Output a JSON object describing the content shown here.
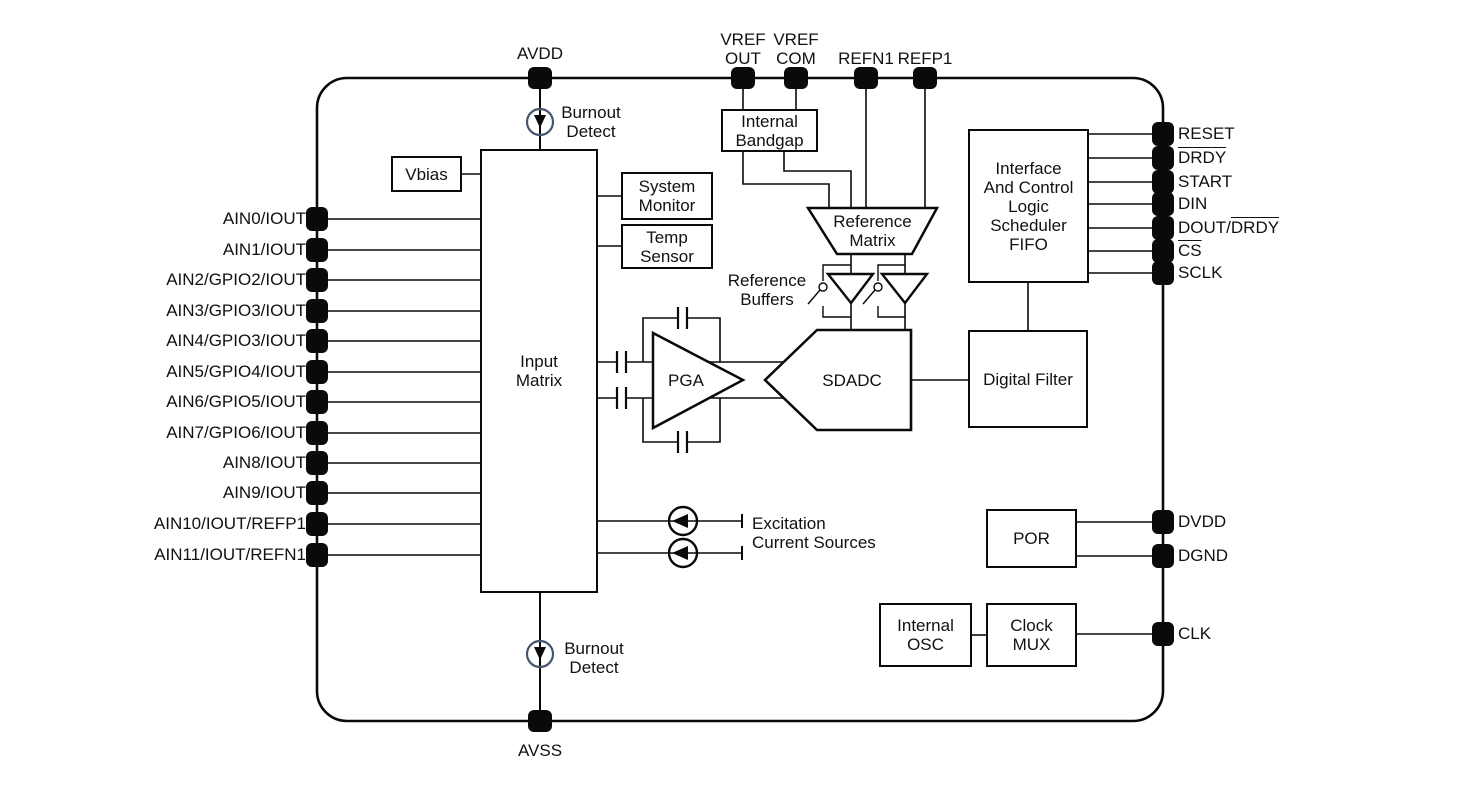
{
  "pins": {
    "top": [
      {
        "label": "AVDD"
      },
      {
        "label": "VREF\nOUT"
      },
      {
        "label": "VREF\nCOM"
      },
      {
        "label": "REFN1"
      },
      {
        "label": "REFP1"
      }
    ],
    "left": [
      {
        "label": "AIN0/IOUT"
      },
      {
        "label": "AIN1/IOUT"
      },
      {
        "label": "AIN2/GPIO2/IOUT"
      },
      {
        "label": "AIN3/GPIO3/IOUT"
      },
      {
        "label": "AIN4/GPIO3/IOUT"
      },
      {
        "label": "AIN5/GPIO4/IOUT"
      },
      {
        "label": "AIN6/GPIO5/IOUT"
      },
      {
        "label": "AIN7/GPIO6/IOUT"
      },
      {
        "label": "AIN8/IOUT"
      },
      {
        "label": "AIN9/IOUT"
      },
      {
        "label": "AIN10/IOUT/REFP1"
      },
      {
        "label": "AIN11/IOUT/REFN1"
      }
    ],
    "right": [
      {
        "plain": "RESET",
        "over": ""
      },
      {
        "plain": "",
        "over": "DRDY"
      },
      {
        "plain": "START",
        "over": ""
      },
      {
        "plain": "DIN",
        "over": ""
      },
      {
        "plain": "DOUT/",
        "over": "DRDY"
      },
      {
        "plain": "",
        "over": "CS"
      },
      {
        "plain": "SCLK",
        "over": ""
      },
      {
        "plain": "DVDD",
        "over": ""
      },
      {
        "plain": "DGND",
        "over": ""
      },
      {
        "plain": "CLK",
        "over": ""
      }
    ],
    "bottom": [
      {
        "label": "AVSS"
      }
    ]
  },
  "blocks": {
    "vbias": "Vbias",
    "input_matrix": "Input\nMatrix",
    "system_monitor": "System\nMonitor",
    "temp_sensor": "Temp\nSensor",
    "internal_bandgap": "Internal\nBandgap",
    "reference_matrix": "Reference\nMatrix",
    "pga": "PGA",
    "sdadc": "SDADC",
    "digital_filter": "Digital Filter",
    "interface": "Interface\nAnd Control\nLogic\nScheduler\nFIFO",
    "por": "POR",
    "internal_osc": "Internal\nOSC",
    "clock_mux": "Clock\nMUX"
  },
  "annotations": {
    "burnout_top": "Burnout\nDetect",
    "burnout_bottom": "Burnout\nDetect",
    "reference_buffers": "Reference\nBuffers",
    "excitation": "Excitation\nCurrent Sources"
  },
  "colors": {
    "wire": "#0a0a0a",
    "burnout_circle": "#44546a",
    "background": "#ffffff"
  }
}
